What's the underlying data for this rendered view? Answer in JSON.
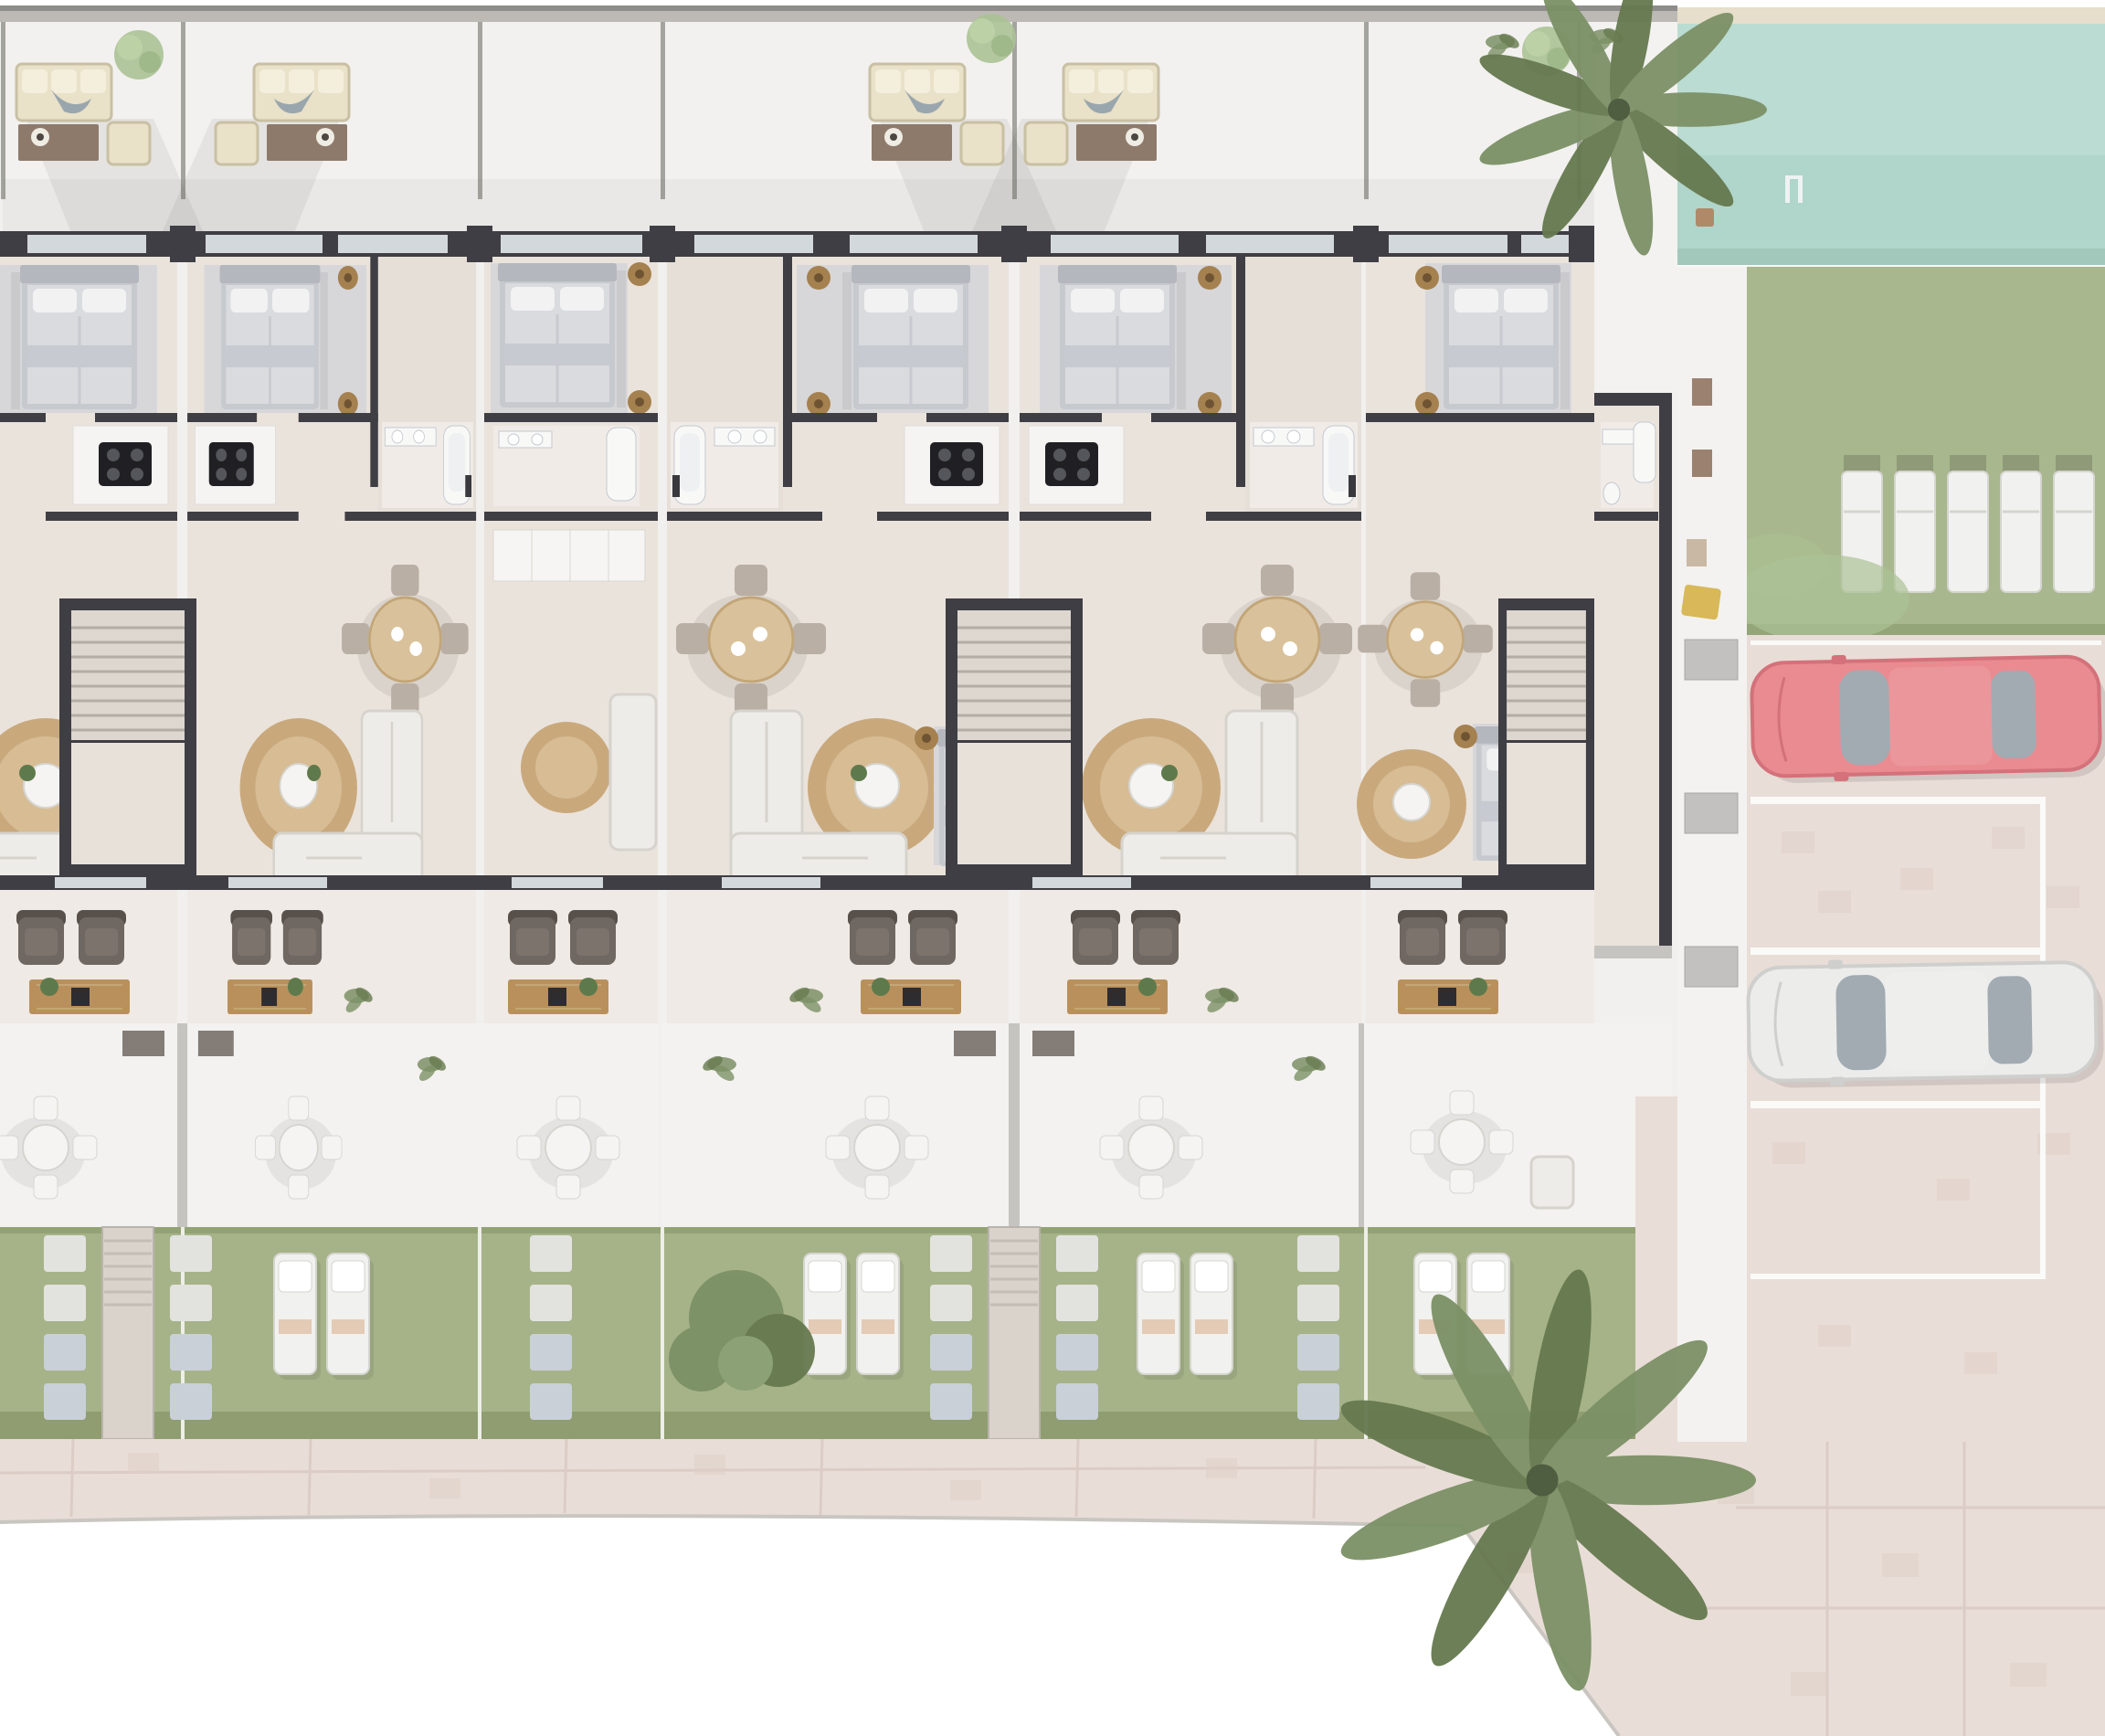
{
  "meta": {
    "title": "Residential complex ground-floor site plan - top-down 3D architectural render",
    "view": "top-down orthographic",
    "visible_text": "none"
  },
  "palette": {
    "page": "#ffffff",
    "ground": "#f1f0ee",
    "terrace": "#f2f1ef",
    "deck": "#f3f2f0",
    "parapet": "#8e8d8b",
    "parapetLight": "#bdbab5",
    "divider": "#97968f",
    "wall": "#3f3e44",
    "wallLight": "#c6c4c0",
    "floor": "#eae3dc",
    "hall": "#e3dcd5",
    "carpet": "#d7d7da",
    "window": "#d3d8dc",
    "frame": "#fdfdfc",
    "headboard": "#b4b7bd",
    "bedFrame": "#c6c9ce",
    "duvet": "#d9dbde",
    "fold": "#c7cad0",
    "pillow": "#f2f2f3",
    "pouf": "#a5814f",
    "poufDark": "#6f5433",
    "fixture": "#f8f8f7",
    "fixtureEdge": "#c4c9cf",
    "bathFloor": "#f0ebe7",
    "counter": "#f5f4f2",
    "cooktop": "#202024",
    "burner": "#55555c",
    "wood": "#d9c29b",
    "woodDark": "#c3a678",
    "chair": "#b9afa5",
    "rug": "#c9a97c",
    "rugIn": "#d7bc94",
    "table": "#f5f4f2",
    "sofa": "#eeece8",
    "sofaEdge": "#d6d3cd",
    "armchair": "#6f6761",
    "armchairDark": "#57504b",
    "cushion": "#7b736c",
    "console": "#b9905c",
    "stairFloor": "#ded7d0",
    "stairLow": "#e7e1da",
    "tread": "#b4ada5",
    "roofSofa": "#e9e1c8",
    "roofSofaEdge": "#c9c0a4",
    "roofTable": "#8e7a6b",
    "bowl": "#efece4",
    "grass": "#a6b389",
    "grassEdge": "#93a274",
    "grassDark": "#89976a",
    "stone": "#e2e3df",
    "stoneShade": "#c9d0d8",
    "lounger": "#f1f1ef",
    "loungerEdge": "#d5d5d0",
    "loungerPad": "#e3cbb6",
    "padDark": "#8f9a78",
    "paver": "#e9ddd7",
    "paverLine": "#d8c8c1",
    "paverDark": "#dfcfc8",
    "sand": "#e7decb",
    "pool": "#badcd2",
    "poolDeep": "#a8d0c2",
    "poolEdge": "#92b5a8",
    "rim": "#ffffff",
    "lawn": "#a8b78d",
    "lawnShade": "#95a57a",
    "parkLine": "#fafaf8",
    "carRed": "#e98b90",
    "carRedDark": "#d4717a",
    "carWhite": "#ececeb",
    "carWhiteDark": "#cfcfcd",
    "glass": "#a2abb2",
    "palm": "#7c9166",
    "palmDark": "#66794f",
    "treeLight": "#abc295",
    "plant": "#5e7a4c",
    "mat": "#d8b858",
    "matBrown": "#9b8170",
    "box": "#c2c1bf",
    "shadow": "#6a6a68"
  },
  "site": {
    "building": {
      "description": "terraced row of townhouses with charcoal walls, staggered toward the right",
      "units": [
        {
          "id": "unit-1",
          "label": "end unit (partially cropped at left)",
          "rooms": [
            "front terrace",
            "bedroom",
            "kitchen",
            "living room",
            "rear terrace",
            "patio",
            "garden"
          ]
        },
        {
          "id": "unit-2",
          "label": "townhouse",
          "rooms": [
            "front terrace",
            "bedroom",
            "bathroom",
            "kitchen",
            "dining",
            "living room",
            "rear terrace",
            "patio",
            "garden"
          ]
        },
        {
          "id": "unit-3",
          "label": "narrow middle unit",
          "rooms": [
            "bedroom",
            "bathroom",
            "wardrobe hall",
            "sitting area",
            "rear terrace",
            "patio",
            "garden"
          ]
        },
        {
          "id": "unit-4",
          "label": "townhouse (mirrored pair left)",
          "rooms": [
            "front terrace",
            "bedroom",
            "bathroom",
            "kitchen",
            "dining",
            "living room",
            "rear terrace",
            "patio",
            "garden"
          ]
        },
        {
          "id": "unit-5",
          "label": "townhouse (mirrored pair right)",
          "rooms": [
            "front terrace",
            "bedroom",
            "bathroom",
            "kitchen",
            "dining",
            "living room",
            "rear terrace",
            "patio",
            "garden"
          ]
        },
        {
          "id": "unit-6",
          "label": "end unit with side wing",
          "rooms": [
            "bedroom",
            "bathroom wing",
            "living room",
            "second bedroom",
            "rear terrace",
            "patio",
            "garden"
          ]
        }
      ],
      "stair_cores": 3,
      "front_terraces": {
        "outdoor_lounge_sets": 4,
        "round_trees": 3,
        "grass_tufts": 1
      }
    },
    "amenities": {
      "pool": {
        "position": "top-right",
        "water": "teal",
        "sand_edge_top": true,
        "ladder": true,
        "side_table": true
      },
      "pool_lawn": {
        "sun_loungers": 5,
        "overhanging_tree": true
      },
      "parking": {
        "surface": "pavers",
        "marked_bays": 4,
        "cars": [
          {
            "color_name": "red",
            "facing": "left"
          },
          {
            "color_name": "white",
            "facing": "left"
          }
        ],
        "empty_bay_between_cars": true
      },
      "side_walkway": {
        "mats": 3,
        "storage_boxes": 3,
        "yellow_mat": 1
      },
      "promenade": {
        "surface": "pavers",
        "curved_lower_edge": true
      }
    },
    "landscape": {
      "gardens": {
        "plots": 5,
        "lounger_pairs": 4,
        "stepping_stone_columns": 6,
        "stair_walkways": 2,
        "shrub": true
      },
      "palm_trees": 2,
      "lawn_trees": 1
    }
  }
}
